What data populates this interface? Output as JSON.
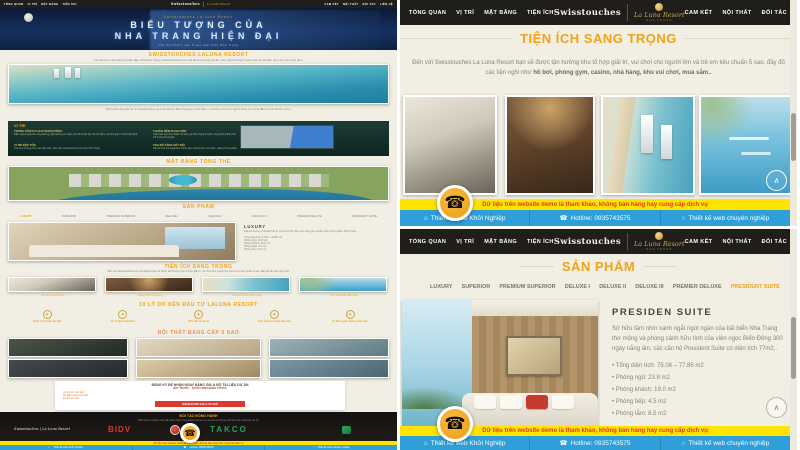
{
  "brand": {
    "swisstouches": "Swisstouches",
    "laluna": "La Luna Resort",
    "laluna_sub": "NHA TRANG"
  },
  "nav": {
    "items": [
      "TỔNG QUAN",
      "VỊ TRÍ",
      "MẶT BẰNG",
      "TIỆN ÍCH",
      "CAM KẾT",
      "NỘI THẤT",
      "ĐỐI TÁC",
      "LIÊN HỆ"
    ]
  },
  "colors": {
    "accent": "#efa31d",
    "navbar": "#201e1b",
    "disclaimer_bg": "#ffe400",
    "disclaimer_text": "#e2382c",
    "footer_bg": "#2f9fd9",
    "gold": "#c9a24b"
  },
  "footer": {
    "disclaimer": "Dữ liệu trên website demo là tham khảo, không bán hàng hay cung cấp dịch vụ",
    "items": [
      {
        "icon": "home-icon",
        "label": "Thiết kế web Khởi Nghiệp"
      },
      {
        "icon": "phone-icon",
        "label": "Hotline: 0935743575"
      },
      {
        "icon": "clock-icon",
        "label": "Thiết kế web chuyên nghiệp"
      }
    ]
  },
  "amenities_panel": {
    "title": "TIỆN ÍCH SANG TRỌNG",
    "intro": "Đến với Swisstouches La Luna Resort bạn sẽ được tận hưởng khu tổ hợp giải trí, vui chơi cho người lớn và trẻ em tiêu chuẩn 5 sao, đầy đủ các tiện nghi như",
    "intro_bold": "hồ bơi, phòng gym, casino, nhà hàng, khu vui chơi, mua sắm..",
    "images": [
      "phong-gym",
      "phong-sinh-hoat-chung",
      "toa-thap-ven-bien",
      "vinh-du-thuyen"
    ]
  },
  "products_panel": {
    "title": "SẢN PHẨM",
    "tabs": [
      "LUXURY",
      "SUPERIOR",
      "PREMIUM SUPERIOR",
      "DELUXE I",
      "DELUXE II",
      "DELUXE III",
      "PREMIER DELUXE",
      "PRESIDENT SUITE"
    ],
    "active_tab": "PRESIDENT SUITE",
    "suite": {
      "name": "PRESIDEN SUITE",
      "desc": "Sở hữu tầm nhìn xanh ngắt ngút ngàn của bãi biển Nha Trang thơ mộng và phong cảnh hữu tình của viên ngọc Biển Đông 300 ngày nắng ấm, các căn hộ President Suite có diện tích 77m2,.",
      "specs": [
        "Tổng diện tích: 75.06 – 77.85 m2",
        "Phòng ngủ: 23.8 m2",
        "Phòng khách: 19.0 m2",
        "Phòng bếp: 4.5 m2",
        "Phòng tắm: 8.5 m2"
      ]
    }
  },
  "left_page": {
    "hero": {
      "pre": "Swisstouches La Luna Resort",
      "title1": "BIỂU TƯỢNG CỦA",
      "title2": "NHA TRANG HIỆN ĐẠI",
      "sub": "Căn hộ khách sạn 5 sao mặt biển Nha Trang"
    },
    "intro": {
      "title": "SWISSTOUCHES LALUNA RESORT",
      "body": "Tọa lạc trên cung đường biển đẹp nhất Nha Trang, Swisstouches La Luna Resort mang chuẩn mực nghỉ dưỡng 5 sao quốc tế với tầm nhìn ôm trọn vịnh biển."
    },
    "panorama_caption": "Phối cảnh tổng thể dự án Swisstouches La Luna Resort Nha Trang bên vịnh biển – nơi hội tụ tinh hoa nghỉ dưỡng và cơ hội đầu tư sinh lời bền vững.",
    "location": {
      "title": "VỊ TRÍ",
      "blocks": [
        {
          "heading": "TRUNG TÂM DU LỊCH NGHỈ DƯỠNG",
          "text": "Nằm ngay trung tâm cung đường nghỉ dưỡng ven biển, kết nối thuận tiện tới các điểm vui chơi giải trí của thành phố."
        },
        {
          "heading": "THUẬN TIỆN DI CHUYỂN",
          "text": "Cách sân bay Cam Ranh 40 phút, ga Nha Trang 10 phút, trung tâm thành phố chỉ 5 phút di chuyển."
        },
        {
          "heading": "VỊ TRÍ ĐỘC TÔN",
          "text": "Tựa sơn hướng thủy, trực diện biển, tầm nhìn panorama ôm trọn vịnh Nha Trang."
        },
        {
          "heading": "TỌA ĐỘ VÀNG KẾT NỐI",
          "text": "Liền kề tiện ích ngoại khu: bệnh viện, trường học, chợ đêm, quảng trường biển."
        }
      ]
    },
    "masterplan_title": "MẶT BẰNG TỔNG THỂ",
    "products": {
      "title": "SẢN PHẨM",
      "room": "LUXURY",
      "desc": "Căn hộ Luxury thiết kế tinh tế, cửa kính lớn đón trọn nắng gió và tầm nhìn hướng biển Nha Trang.",
      "specs": [
        "Tổng diện tích: 41.06 – 44.85 m2",
        "Phòng ngủ: 18.8 m2",
        "Phòng khách: 12.0 m2",
        "Phòng bếp: 4.5 m2",
        "Phòng tắm: 6.5 m2"
      ]
    },
    "amenities": {
      "title": "TIỆN ÍCH SANG TRỌNG",
      "captions": [
        "Bể bơi & khu Fitness",
        "Phòng sinh hoạt chung",
        "Khu đô thị biển Nha Trang",
        "Vịnh du thuyền đẳng cấp"
      ]
    },
    "reasons": {
      "title": "10 LÝ DO NÊN ĐẦU TƯ LALUNA RESORT",
      "items": [
        "Pháp lý sở hữu lâu dài",
        "Vị trí vàng mặt biển",
        "Chủ đầu tư uy tín",
        "Cam kết lợi nhuận hấp dẫn",
        "10 đêm nghỉ dưỡng mỗi năm"
      ]
    },
    "interior_title": "NỘI THẤT ĐẲNG CẤP 5 SAO",
    "form": {
      "title": "ĐĂNG KÝ ĐỂ NHẬN NGAY BẢNG GIÁ & BỘ TÀI LIỆU DỰ ÁN",
      "subtitle": "ĐẶT TRƯỚC – QUYẾT ĐỊNH ĐÚNG TRƯỚC",
      "fields": [
        "Họ và tên của bạn",
        "Số điện thoại của bạn",
        "Email của bạn"
      ],
      "button": "NHẬN BẢNG GIÁ & ƯU ĐÃI"
    },
    "partners": {
      "title": "ĐỐI TÁC ĐỒNG HÀNH",
      "desc": "Những thương hiệu hàng đầu đồng hành cùng Swisstouches La Luna Resort trong suốt quá trình phát triển dự án.",
      "logos": [
        "Swisstouches | La Luna Resort",
        "BIDV",
        "TAKCO"
      ]
    }
  },
  "icons": {
    "phone": "☎",
    "home": "⌂",
    "clock": "○",
    "up": "∧",
    "bullet": "•",
    "star": "✦"
  }
}
